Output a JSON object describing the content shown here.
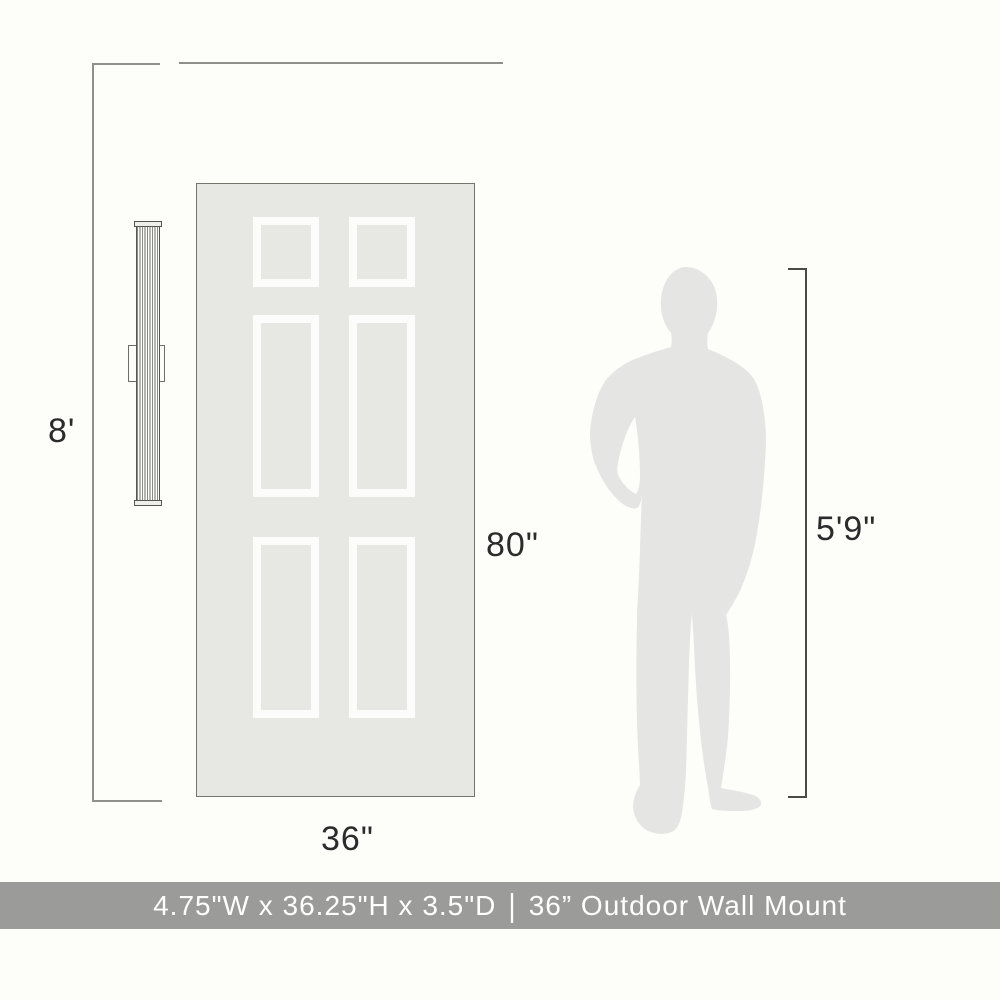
{
  "figure": {
    "type": "product-scale-diagram",
    "door": "six-panel-door",
    "fixture": "linear-fluted-wall-sconce",
    "person": "male-silhouette"
  },
  "annotations": {
    "wall_height": "8'",
    "door_height": "80\"",
    "door_width": "36\"",
    "person_height": "5'9\""
  },
  "footer": {
    "dimensions": "4.75\"W x 36.25\"H x 3.5\"D",
    "separator": "|",
    "product_name": "36” Outdoor Wall Mount"
  },
  "colors": {
    "background": "#fdfdfa",
    "door_fill": "#e7e7e4",
    "panel_frame": "#fcfcfa",
    "silhouette": "#e5e5e3",
    "dimension_line_gray": "#8f8f8c",
    "dimension_line_dark": "#4a4a47",
    "label_text": "#2b2b2b",
    "footer_bar": "#9b9b99",
    "footer_text": "#ffffff"
  }
}
